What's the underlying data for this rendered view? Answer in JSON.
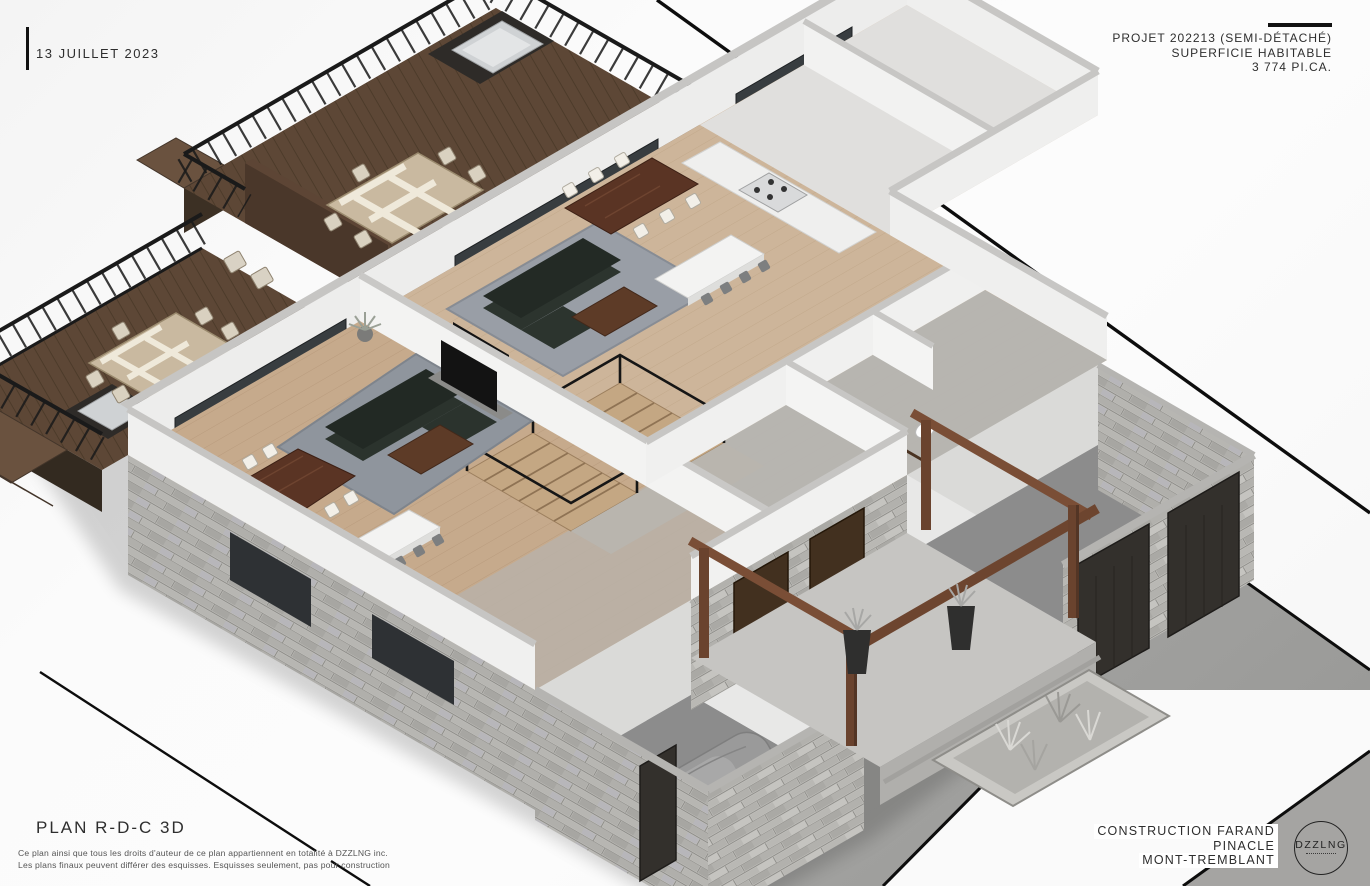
{
  "sheet": {
    "date_label": "13 JUILLET 2023",
    "project_lines": [
      "PROJET 202213 (SEMI-DÉTACHÉ)",
      "SUPERFICIE HABITABLE",
      "3 774 PI.CA."
    ],
    "plan_title": "PLAN R-D-C 3D",
    "disclaimer_lines": [
      "Ce plan ainsi que tous les droits d'auteur de ce plan appartiennent en totalité à DZZLNG inc.",
      "Les plans finaux peuvent différer des esquisses. Esquisses seulement, pas pour construction"
    ],
    "firm_lines": [
      "CONSTRUCTION FARAND",
      "PINACLE",
      "MONT-TREMBLANT"
    ],
    "logo_text": "DZZLNG"
  },
  "colors": {
    "sheet_background": "#fbfbfb",
    "boundary_line": "#0d0d0d",
    "driveway_gray": "#a0a0a0",
    "deck_wood": "#5d4736",
    "interior_floor": "#cdb59a",
    "cut_wall_top": "#c6c5c3",
    "wall_white": "#f1f1f0",
    "stone_veneer": "#bdbcb8",
    "timber_brown": "#6d452f",
    "sofa_dark": "#2c342e",
    "table_wood": "#5a3424",
    "railing_black": "#1a1a1a"
  },
  "floorplan": {
    "view": "isometric 3d cutaway of ground floor, semi-detached duplex",
    "features": [
      "rear-deck-left",
      "rear-deck-right",
      "outdoor-dining-sets",
      "built-in-bbq-grills",
      "deck-stairs",
      "black-railings",
      "open-plan-living-rooms",
      "sectional-sofas",
      "tv-units",
      "kitchen-islands-with-stools",
      "gas-range",
      "mirrored-staircases",
      "bathrooms",
      "double-garages",
      "covered-car",
      "stone-veneer-walls",
      "timber-pergola-porch",
      "planters",
      "ornamental-grass-bed",
      "driveway"
    ]
  }
}
